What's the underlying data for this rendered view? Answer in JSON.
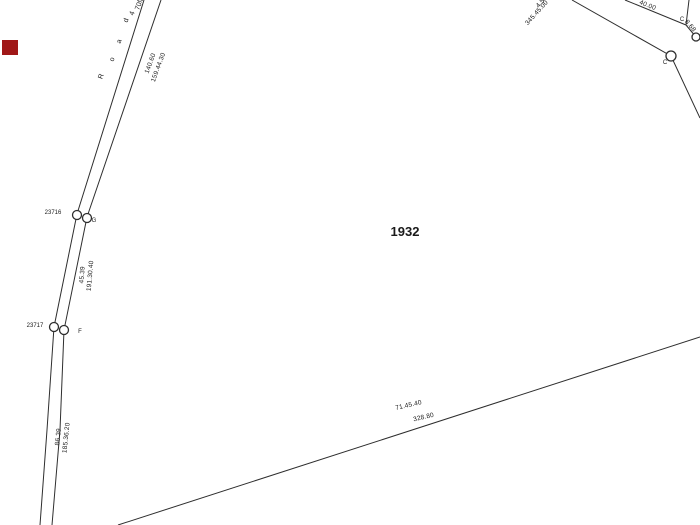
{
  "map": {
    "parcel": {
      "number": "1932",
      "color": "#cc0000"
    },
    "road_name": {
      "chars": [
        "R",
        "o",
        "a",
        "d",
        "4",
        "70ft"
      ]
    },
    "dimensions": {
      "road_edge": [
        "140.60",
        "159.44.30"
      ],
      "segment_g_to_f": [
        "45.39",
        "191.30.40"
      ],
      "segment_below_f": [
        "86.39",
        "185.36.20"
      ],
      "bottom_boundary": [
        "71.45.40",
        "328.80"
      ],
      "top_right_pair": [
        "4.50",
        "345.45.00"
      ],
      "top_right_width": "40.00",
      "top_right_short": "8.68"
    },
    "points": {
      "g": {
        "id": "23716",
        "label": "G"
      },
      "f": {
        "id": "23717",
        "label": "F"
      },
      "c_upper": {
        "label": "C"
      },
      "c_lower": {
        "label": "C"
      }
    },
    "marker_color": "#a01818",
    "line_color": "#2e2e2e",
    "background_color": "#ffffff"
  }
}
